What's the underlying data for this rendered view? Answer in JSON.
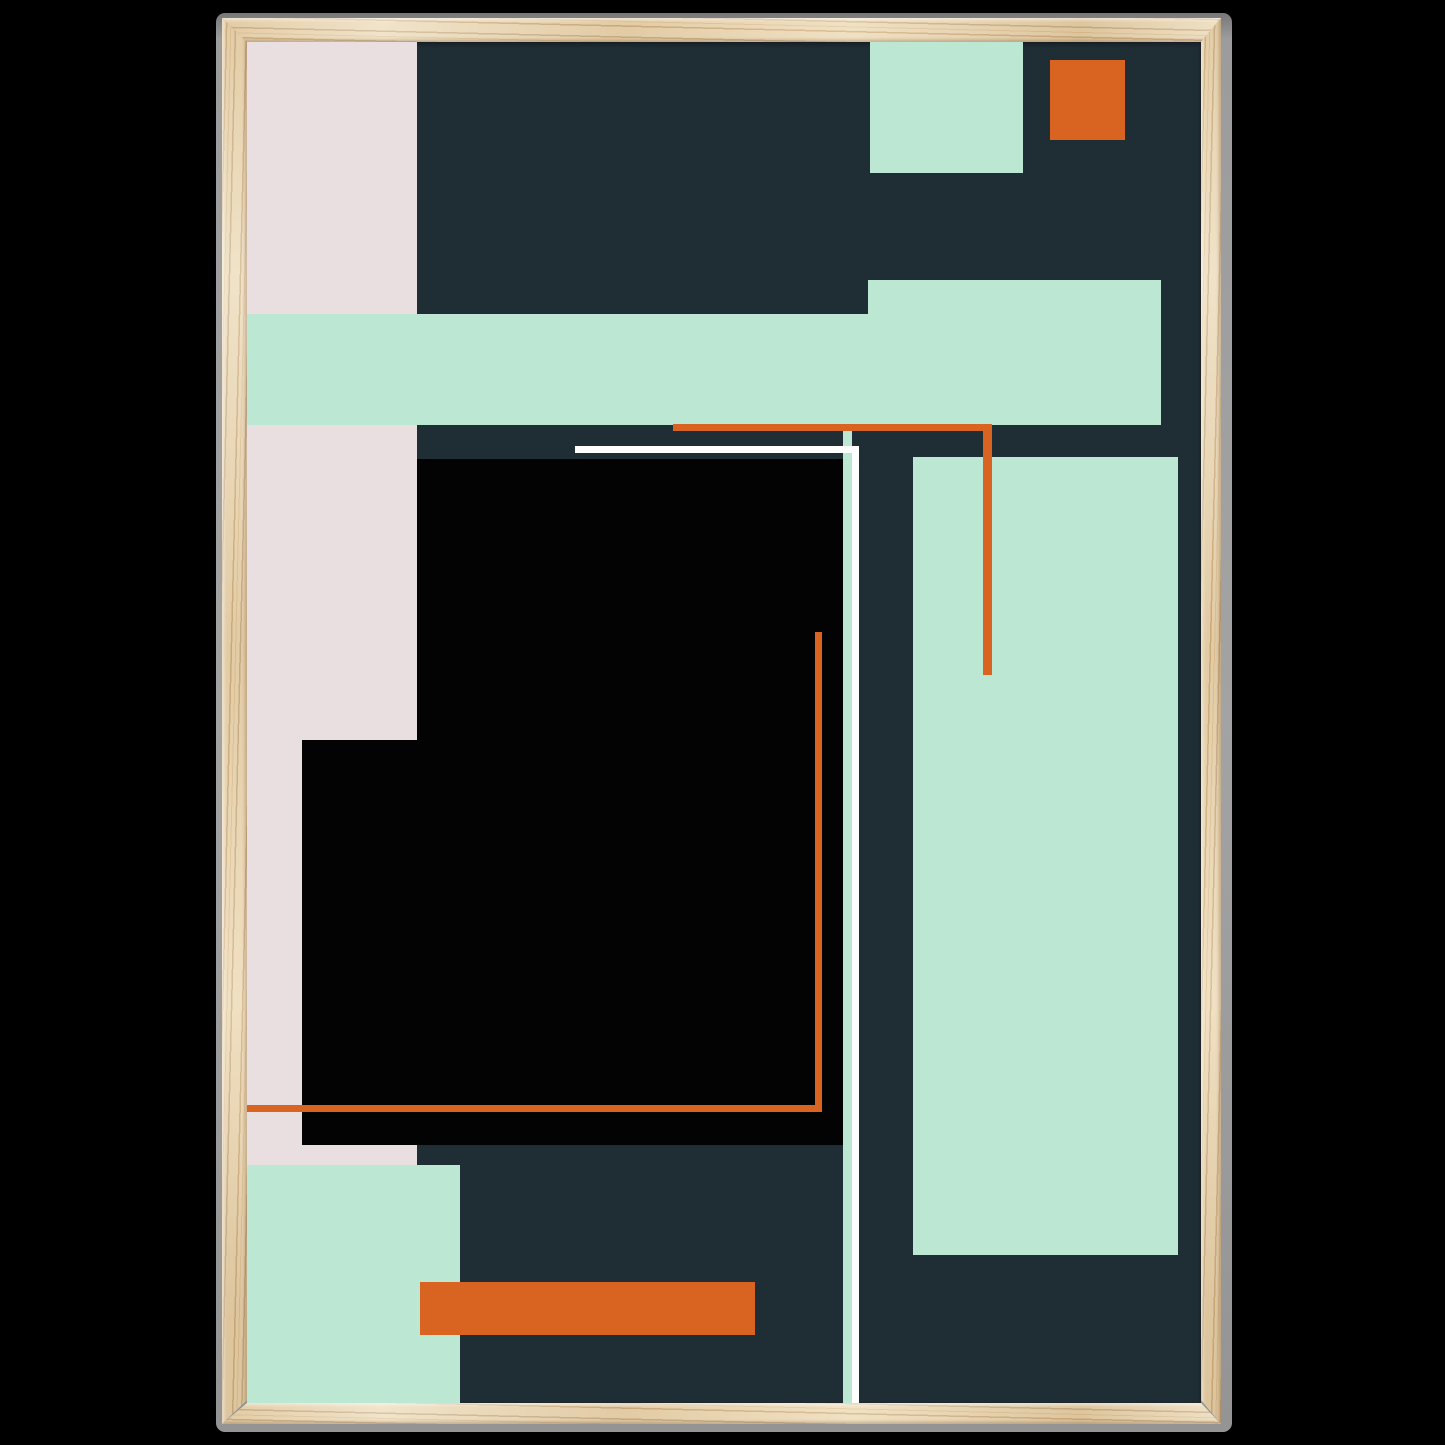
{
  "palette": {
    "page_bg": "#000000",
    "shadow_gray": "#9e9e9e",
    "wood_base": "#ecdab7",
    "navy": "#1f2d35",
    "black": "#030303",
    "mint": "#bce7d2",
    "pink": "#e9dfe1",
    "orange": "#d96321",
    "white": "#ffffff"
  },
  "artwork": {
    "style": "abstract geometric composition",
    "background": "navy",
    "shapes": [
      {
        "name": "pink-column-left",
        "color": "pink",
        "x": 0,
        "y": 0,
        "w": 170,
        "h": 1123
      },
      {
        "name": "black-block-main",
        "color": "black",
        "x": 170,
        "y": 417,
        "w": 426,
        "h": 686
      },
      {
        "name": "black-block-left-step",
        "color": "black",
        "x": 55,
        "y": 698,
        "w": 115,
        "h": 405
      },
      {
        "name": "mint-band-horizontal",
        "color": "mint",
        "x": 0,
        "y": 272,
        "w": 914,
        "h": 111
      },
      {
        "name": "mint-band-right-bump",
        "color": "mint",
        "x": 621,
        "y": 238,
        "w": 293,
        "h": 145
      },
      {
        "name": "mint-square-top-right",
        "color": "mint",
        "x": 623,
        "y": 0,
        "w": 153,
        "h": 131
      },
      {
        "name": "orange-square-top-right",
        "color": "orange",
        "x": 803,
        "y": 18,
        "w": 75,
        "h": 80
      },
      {
        "name": "mint-panel-right",
        "color": "mint",
        "x": 666,
        "y": 415,
        "w": 265,
        "h": 798
      },
      {
        "name": "mint-panel-bottom-left",
        "color": "mint",
        "x": 0,
        "y": 1123,
        "w": 213,
        "h": 238
      },
      {
        "name": "mint-sliver-vertical",
        "color": "mint",
        "x": 596,
        "y": 383,
        "w": 9,
        "h": 978
      },
      {
        "name": "white-line-horizontal",
        "color": "white",
        "x": 328,
        "y": 404,
        "w": 284,
        "h": 7
      },
      {
        "name": "white-line-vertical",
        "color": "white",
        "x": 605,
        "y": 404,
        "w": 7,
        "h": 957
      },
      {
        "name": "orange-line-top-horizontal",
        "color": "orange",
        "x": 426,
        "y": 382,
        "w": 319,
        "h": 7
      },
      {
        "name": "orange-line-top-vertical",
        "color": "orange",
        "x": 736,
        "y": 382,
        "w": 9,
        "h": 251
      },
      {
        "name": "orange-line-inner-vertical",
        "color": "orange",
        "x": 568,
        "y": 590,
        "w": 7,
        "h": 480
      },
      {
        "name": "orange-line-bottom-horizontal",
        "color": "orange",
        "x": 0,
        "y": 1063,
        "w": 575,
        "h": 7
      },
      {
        "name": "orange-bar-bottom",
        "color": "orange",
        "x": 173,
        "y": 1240,
        "w": 335,
        "h": 53
      }
    ]
  }
}
